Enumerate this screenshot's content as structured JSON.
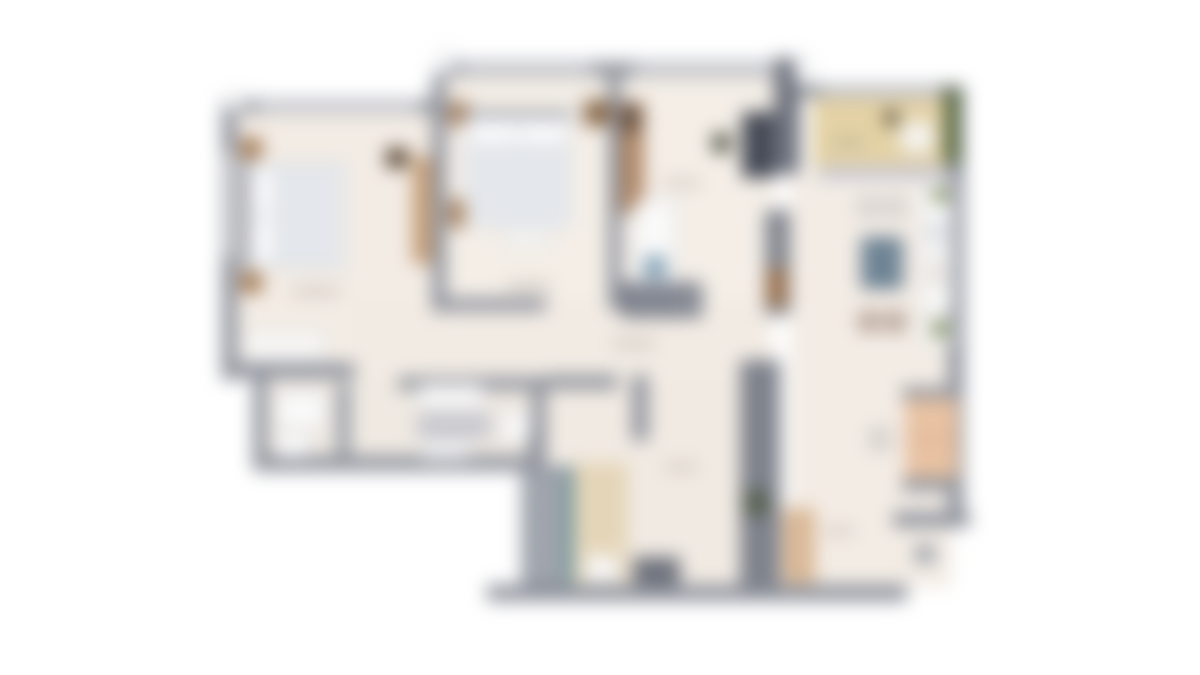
{
  "image": {
    "description": "blurred-apartment-floorplan",
    "width": 1200,
    "height": 675,
    "background": "#ffffff"
  },
  "palette": {
    "wall_gray": "#8d919b",
    "wall_dark": "#6f737e",
    "floor_cream": "#f3ece5",
    "balcony_tan": "#e4d2a6",
    "hedge_green": "#55663e",
    "wood_brown": "#a37a54",
    "mattress_white": "#e9ebee",
    "table_slate": "#6e8495",
    "sofa_peach": "#e8c2a2",
    "stair_teal": "#5f8d96",
    "stair_beige": "#e7d8bc",
    "label_smudge": "#b6afa8"
  },
  "floorplan": {
    "regions": [
      {
        "name": "floor-left-bedroom",
        "x": 228,
        "y": 106,
        "w": 217,
        "h": 268,
        "fill": "#f3ece5"
      },
      {
        "name": "floor-middle-block",
        "x": 446,
        "y": 76,
        "w": 330,
        "h": 236,
        "fill": "#f4eee7"
      },
      {
        "name": "floor-right-block",
        "x": 790,
        "y": 172,
        "w": 162,
        "h": 415,
        "fill": "#f3ece5"
      },
      {
        "name": "floor-hall-mid",
        "x": 352,
        "y": 300,
        "w": 420,
        "h": 82,
        "fill": "#f2ebe4"
      },
      {
        "name": "floor-bottom-block",
        "x": 542,
        "y": 382,
        "w": 200,
        "h": 206,
        "fill": "#f1eae3"
      },
      {
        "name": "floor-bathrooms",
        "x": 255,
        "y": 377,
        "w": 290,
        "h": 86,
        "fill": "#efe9e2"
      },
      {
        "name": "floor-balcony",
        "x": 812,
        "y": 92,
        "w": 136,
        "h": 78,
        "fill": "#e4d2a6"
      },
      {
        "name": "wall-top-left-block",
        "x": 222,
        "y": 100,
        "w": 226,
        "h": 13,
        "fill": "#8d919b"
      },
      {
        "name": "wall-top-middle-block",
        "x": 436,
        "y": 62,
        "w": 360,
        "h": 14,
        "fill": "#8d919b"
      },
      {
        "name": "wall-top-right-block",
        "x": 790,
        "y": 85,
        "w": 172,
        "h": 12,
        "fill": "#8d919b"
      },
      {
        "name": "wall-left-outer",
        "x": 222,
        "y": 100,
        "w": 15,
        "h": 280,
        "fill": "#8d919b"
      },
      {
        "name": "wall-shaft-top-right",
        "x": 774,
        "y": 58,
        "w": 26,
        "h": 116,
        "fill": "#6f737e"
      },
      {
        "name": "wall-right-outer",
        "x": 948,
        "y": 85,
        "w": 16,
        "h": 442,
        "fill": "#8d919b"
      },
      {
        "name": "wall-bottom-right-living",
        "x": 893,
        "y": 512,
        "w": 77,
        "h": 15,
        "fill": "#8d919b"
      },
      {
        "name": "wall-bottom-main",
        "x": 487,
        "y": 585,
        "w": 420,
        "h": 16,
        "fill": "#8d919b"
      },
      {
        "name": "pillar-outside",
        "x": 915,
        "y": 545,
        "w": 20,
        "h": 18,
        "fill": "#9ba0a8"
      },
      {
        "name": "wall-bed1-bed2",
        "x": 432,
        "y": 76,
        "w": 14,
        "h": 236,
        "fill": "#8d919b"
      },
      {
        "name": "wall-bed2-room3",
        "x": 608,
        "y": 76,
        "w": 13,
        "h": 234,
        "fill": "#8d919b"
      },
      {
        "name": "wall-bed1-bottom",
        "x": 222,
        "y": 363,
        "w": 133,
        "h": 15,
        "fill": "#8d919b"
      },
      {
        "name": "wall-bath-left",
        "x": 253,
        "y": 370,
        "w": 14,
        "h": 100,
        "fill": "#8d919b"
      },
      {
        "name": "wall-bath-bottom",
        "x": 253,
        "y": 456,
        "w": 293,
        "h": 15,
        "fill": "#8d919b"
      },
      {
        "name": "wall-bath-divider",
        "x": 337,
        "y": 383,
        "w": 13,
        "h": 78,
        "fill": "#9196a0"
      },
      {
        "name": "wall-bath-right",
        "x": 532,
        "y": 377,
        "w": 14,
        "h": 84,
        "fill": "#8d919b"
      },
      {
        "name": "wall-bath2-top",
        "x": 398,
        "y": 377,
        "w": 148,
        "h": 13,
        "fill": "#8d919b"
      },
      {
        "name": "wall-bed2-bottom",
        "x": 446,
        "y": 298,
        "w": 100,
        "h": 13,
        "fill": "#8d919b"
      },
      {
        "name": "wall-hall-top",
        "x": 545,
        "y": 375,
        "w": 73,
        "h": 14,
        "fill": "#8d919b"
      },
      {
        "name": "wall-hall-stub",
        "x": 632,
        "y": 375,
        "w": 16,
        "h": 66,
        "fill": "#8d919b"
      },
      {
        "name": "wall-shaft-mid",
        "x": 765,
        "y": 210,
        "w": 25,
        "h": 105,
        "fill": "#81858f"
      },
      {
        "name": "wall-shaft-bottom",
        "x": 740,
        "y": 360,
        "w": 40,
        "h": 228,
        "fill": "#7e828c"
      },
      {
        "name": "shaft-door-green",
        "x": 744,
        "y": 490,
        "w": 24,
        "h": 26,
        "fill": "#57604f"
      },
      {
        "name": "wall-stair-left",
        "x": 528,
        "y": 430,
        "w": 14,
        "h": 158,
        "fill": "#8d919b"
      },
      {
        "name": "window-strip",
        "x": 258,
        "y": 103,
        "w": 160,
        "h": 8,
        "fill": "#d9dade"
      },
      {
        "name": "window-strip",
        "x": 462,
        "y": 65,
        "w": 130,
        "h": 8,
        "fill": "#d9dade"
      },
      {
        "name": "window-strip",
        "x": 635,
        "y": 65,
        "w": 140,
        "h": 8,
        "fill": "#d9dade"
      },
      {
        "name": "window-strip",
        "x": 822,
        "y": 88,
        "w": 118,
        "h": 7,
        "fill": "#d9dade"
      },
      {
        "name": "window-strip",
        "x": 225,
        "y": 152,
        "w": 8,
        "h": 105,
        "fill": "#d9dade"
      },
      {
        "name": "window-tab",
        "x": 226,
        "y": 92,
        "w": 17,
        "h": 19,
        "fill": "#fefefe",
        "stroke": "#aeb1b8"
      },
      {
        "name": "window-tab",
        "x": 437,
        "y": 50,
        "w": 16,
        "h": 23,
        "fill": "#fefefe",
        "stroke": "#aeb1b8"
      },
      {
        "name": "window-tab",
        "x": 795,
        "y": 57,
        "w": 17,
        "h": 26,
        "fill": "#fefefe",
        "stroke": "#aeb1b8"
      },
      {
        "name": "balcony-hedge",
        "x": 944,
        "y": 88,
        "w": 16,
        "h": 76,
        "fill": "#55663e"
      },
      {
        "name": "balcony-plant",
        "x": 884,
        "y": 110,
        "w": 15,
        "h": 16,
        "fill": "#57503c",
        "radius": 7
      },
      {
        "name": "balcony-lounge-chair",
        "x": 900,
        "y": 121,
        "w": 34,
        "h": 32,
        "fill": "#f6f4f0",
        "stroke": "#c9c4ba",
        "radius": 6
      },
      {
        "name": "balcony-sliding-door",
        "x": 818,
        "y": 166,
        "w": 130,
        "h": 13,
        "fill": "#c6c6d2"
      },
      {
        "name": "bed1-headboard",
        "x": 241,
        "y": 160,
        "w": 8,
        "h": 110,
        "fill": "#9a9da6"
      },
      {
        "name": "bed1-mattress",
        "x": 249,
        "y": 162,
        "w": 97,
        "h": 107,
        "fill": "#e9ebee",
        "stroke": "#c6c9ce"
      },
      {
        "name": "bed1-pillow",
        "x": 253,
        "y": 170,
        "w": 17,
        "h": 43,
        "fill": "#fbfbfc",
        "radius": 5
      },
      {
        "name": "bed1-pillow",
        "x": 253,
        "y": 219,
        "w": 17,
        "h": 43,
        "fill": "#fbfbfc",
        "radius": 5
      },
      {
        "name": "bed1-blanket",
        "x": 272,
        "y": 164,
        "w": 74,
        "h": 103,
        "fill": "#e4e7eb"
      },
      {
        "name": "bed1-nightstand",
        "x": 240,
        "y": 138,
        "w": 22,
        "h": 21,
        "fill": "#a37a54"
      },
      {
        "name": "bed1-nightstand",
        "x": 240,
        "y": 272,
        "w": 22,
        "h": 21,
        "fill": "#a37a54"
      },
      {
        "name": "bed1-dresser",
        "x": 243,
        "y": 330,
        "w": 83,
        "h": 33,
        "fill": "#f7f6f4",
        "stroke": "#b9bcc1"
      },
      {
        "name": "bed1-dark-item",
        "x": 386,
        "y": 148,
        "w": 22,
        "h": 20,
        "fill": "#5c4a38"
      },
      {
        "name": "bed1-wardrobe",
        "x": 412,
        "y": 156,
        "w": 20,
        "h": 108,
        "fill": "#c7a17b"
      },
      {
        "name": "bed2-nightstand",
        "x": 449,
        "y": 102,
        "w": 20,
        "h": 24,
        "fill": "#a37a54"
      },
      {
        "name": "bed2-side-chest",
        "x": 449,
        "y": 199,
        "w": 19,
        "h": 29,
        "fill": "#a37a54"
      },
      {
        "name": "bed2-headboard",
        "x": 462,
        "y": 110,
        "w": 110,
        "h": 8,
        "fill": "#9a9da6"
      },
      {
        "name": "bed2-mattress",
        "x": 464,
        "y": 117,
        "w": 107,
        "h": 111,
        "fill": "#e9ebee",
        "stroke": "#c6c9ce"
      },
      {
        "name": "bed2-pillow",
        "x": 470,
        "y": 122,
        "w": 46,
        "h": 19,
        "fill": "#fbfbfc",
        "radius": 5
      },
      {
        "name": "bed2-pillow",
        "x": 521,
        "y": 122,
        "w": 45,
        "h": 19,
        "fill": "#fbfbfc",
        "radius": 5
      },
      {
        "name": "bed2-blanket",
        "x": 464,
        "y": 143,
        "w": 107,
        "h": 85,
        "fill": "#e4e7eb"
      },
      {
        "name": "bed2-bench",
        "x": 503,
        "y": 230,
        "w": 48,
        "h": 18,
        "fill": "#f7f6f4",
        "stroke": "#b9bcc1"
      },
      {
        "name": "bed2-nightstand",
        "x": 584,
        "y": 100,
        "w": 26,
        "h": 26,
        "fill": "#8a6a4a"
      },
      {
        "name": "room3-wardrobe",
        "x": 620,
        "y": 102,
        "w": 24,
        "h": 112,
        "fill": "#b08969"
      },
      {
        "name": "room3-wardrobe-dark",
        "x": 621,
        "y": 104,
        "w": 20,
        "h": 28,
        "fill": "#6b5340"
      },
      {
        "name": "room3-desk",
        "x": 742,
        "y": 112,
        "w": 32,
        "h": 66,
        "fill": "#454a56"
      },
      {
        "name": "room3-chair",
        "x": 712,
        "y": 133,
        "w": 19,
        "h": 20,
        "fill": "#5d6052"
      },
      {
        "name": "room3-door-leaf",
        "x": 766,
        "y": 268,
        "w": 21,
        "h": 38,
        "fill": "#9b7350"
      },
      {
        "name": "stair-upper-landing",
        "x": 634,
        "y": 200,
        "w": 42,
        "h": 84,
        "fill": "#fafafa",
        "stroke": "#b5b8bd"
      },
      {
        "name": "stair-upper-blue",
        "x": 644,
        "y": 256,
        "w": 22,
        "h": 22,
        "fill": "#7f9fb3"
      },
      {
        "name": "stair-mid-dark",
        "x": 622,
        "y": 282,
        "w": 80,
        "h": 36,
        "fill": "#6f7480"
      },
      {
        "name": "stair-tread",
        "x": 638,
        "y": 284,
        "w": 3,
        "h": 32,
        "fill": "#e8e8ea"
      },
      {
        "name": "stair-tread",
        "x": 656,
        "y": 284,
        "w": 3,
        "h": 32,
        "fill": "#e8e8ea"
      },
      {
        "name": "stair-tread",
        "x": 674,
        "y": 284,
        "w": 3,
        "h": 32,
        "fill": "#e8e8ea"
      },
      {
        "name": "stair-tread",
        "x": 690,
        "y": 284,
        "w": 3,
        "h": 32,
        "fill": "#e8e8ea"
      },
      {
        "name": "stair-flight-gray",
        "x": 521,
        "y": 466,
        "w": 44,
        "h": 120,
        "fill": "#999ea7"
      },
      {
        "name": "stair-tread",
        "x": 523,
        "y": 486,
        "w": 40,
        "h": 3,
        "fill": "#c6c9ce"
      },
      {
        "name": "stair-tread",
        "x": 523,
        "y": 506,
        "w": 40,
        "h": 3,
        "fill": "#c6c9ce"
      },
      {
        "name": "stair-tread",
        "x": 523,
        "y": 526,
        "w": 40,
        "h": 3,
        "fill": "#c6c9ce"
      },
      {
        "name": "stair-tread",
        "x": 523,
        "y": 546,
        "w": 40,
        "h": 3,
        "fill": "#c6c9ce"
      },
      {
        "name": "stair-tread",
        "x": 523,
        "y": 566,
        "w": 40,
        "h": 3,
        "fill": "#c6c9ce"
      },
      {
        "name": "stair-divider-teal",
        "x": 565,
        "y": 466,
        "w": 8,
        "h": 118,
        "fill": "#5f8d96"
      },
      {
        "name": "stair-flight-beige",
        "x": 573,
        "y": 462,
        "w": 55,
        "h": 122,
        "fill": "#e7d8bc"
      },
      {
        "name": "stair-tread",
        "x": 575,
        "y": 478,
        "w": 51,
        "h": 2,
        "fill": "#cdbd9e"
      },
      {
        "name": "stair-tread",
        "x": 575,
        "y": 496,
        "w": 51,
        "h": 2,
        "fill": "#cdbd9e"
      },
      {
        "name": "stair-tread",
        "x": 575,
        "y": 514,
        "w": 51,
        "h": 2,
        "fill": "#cdbd9e"
      },
      {
        "name": "stair-tread",
        "x": 575,
        "y": 532,
        "w": 51,
        "h": 2,
        "fill": "#cdbd9e"
      },
      {
        "name": "stair-landing",
        "x": 586,
        "y": 556,
        "w": 32,
        "h": 26,
        "fill": "#fafafa",
        "stroke": "#c0c3c8"
      },
      {
        "name": "entry-mat",
        "x": 633,
        "y": 557,
        "w": 47,
        "h": 28,
        "fill": "#6e727c"
      },
      {
        "name": "bath1-shower",
        "x": 276,
        "y": 391,
        "w": 50,
        "h": 38,
        "fill": "#fafafa",
        "stroke": "#b5b8bd"
      },
      {
        "name": "bath1-toilet",
        "x": 278,
        "y": 433,
        "w": 31,
        "h": 25,
        "fill": "#fbfbfc",
        "stroke": "#c0c3c8",
        "radius": 6
      },
      {
        "name": "bath2-tub",
        "x": 417,
        "y": 384,
        "w": 68,
        "h": 24,
        "fill": "#fafafa",
        "stroke": "#b5b8bd",
        "radius": 8
      },
      {
        "name": "bath2-counter",
        "x": 417,
        "y": 412,
        "w": 74,
        "h": 27,
        "fill": "#c9c9cf"
      },
      {
        "name": "bath2-toilet",
        "x": 501,
        "y": 414,
        "w": 30,
        "h": 27,
        "fill": "#fbfbfc",
        "stroke": "#c0c3c8",
        "radius": 9
      },
      {
        "name": "bath2-sink",
        "x": 421,
        "y": 442,
        "w": 48,
        "h": 18,
        "fill": "#f2f2f4",
        "stroke": "#c0c3c8"
      },
      {
        "name": "dining-chair",
        "x": 858,
        "y": 197,
        "w": 22,
        "h": 20,
        "fill": "#d9d5d1",
        "stroke": "#adb0b5",
        "radius": 5
      },
      {
        "name": "dining-chair",
        "x": 884,
        "y": 197,
        "w": 22,
        "h": 20,
        "fill": "#d9d5d1",
        "stroke": "#adb0b5",
        "radius": 5
      },
      {
        "name": "dining-table",
        "x": 861,
        "y": 237,
        "w": 42,
        "h": 52,
        "fill": "#6e8495",
        "stroke": "#5a6e7e"
      },
      {
        "name": "dining-chair",
        "x": 858,
        "y": 311,
        "w": 22,
        "h": 21,
        "fill": "#b9a79b",
        "stroke": "#a3968c",
        "radius": 5
      },
      {
        "name": "dining-chair",
        "x": 884,
        "y": 311,
        "w": 22,
        "h": 21,
        "fill": "#b9a79b",
        "stroke": "#a3968c",
        "radius": 5
      },
      {
        "name": "kitchen-counter",
        "x": 921,
        "y": 182,
        "w": 32,
        "h": 130,
        "fill": "#fafafa",
        "stroke": "#bfc2c7"
      },
      {
        "name": "kitchen-sink",
        "x": 927,
        "y": 220,
        "w": 20,
        "h": 26,
        "fill": "#dfe2e6"
      },
      {
        "name": "kitchen-stove",
        "x": 927,
        "y": 258,
        "w": 20,
        "h": 30,
        "fill": "#e8e5e1"
      },
      {
        "name": "kitchen-plant",
        "x": 932,
        "y": 187,
        "w": 17,
        "h": 16,
        "fill": "#7a8b5a",
        "radius": 8
      },
      {
        "name": "kitchen-cabinet",
        "x": 921,
        "y": 316,
        "w": 32,
        "h": 30,
        "fill": "#fafafa",
        "stroke": "#bfc2c7"
      },
      {
        "name": "kitchen-plant",
        "x": 931,
        "y": 320,
        "w": 18,
        "h": 18,
        "fill": "#7a8b5a",
        "radius": 9
      },
      {
        "name": "sofa-armrest",
        "x": 902,
        "y": 387,
        "w": 57,
        "h": 13,
        "fill": "#8f939d"
      },
      {
        "name": "sofa-body",
        "x": 905,
        "y": 398,
        "w": 53,
        "h": 84,
        "fill": "#e8c2a2"
      },
      {
        "name": "sofa-cushion-line",
        "x": 905,
        "y": 438,
        "w": 53,
        "h": 3,
        "fill": "#d9ad8d"
      },
      {
        "name": "sofa-armrest",
        "x": 902,
        "y": 478,
        "w": 57,
        "h": 13,
        "fill": "#8f939d"
      },
      {
        "name": "side-table",
        "x": 869,
        "y": 427,
        "w": 22,
        "h": 24,
        "fill": "#d8d3cd",
        "stroke": "#b9bcc1"
      },
      {
        "name": "tv-cabinet",
        "x": 782,
        "y": 508,
        "w": 33,
        "h": 76,
        "fill": "#d9b896"
      },
      {
        "name": "room-label-smudge",
        "x": 292,
        "y": 287,
        "w": 48,
        "h": 9,
        "fill": "#b6afa8",
        "radius": 4,
        "opacity": 0.55
      },
      {
        "name": "room-label-smudge",
        "x": 506,
        "y": 282,
        "w": 45,
        "h": 9,
        "fill": "#b6afa8",
        "radius": 4,
        "opacity": 0.55
      },
      {
        "name": "room-label-smudge",
        "x": 663,
        "y": 179,
        "w": 38,
        "h": 8,
        "fill": "#b6afa8",
        "radius": 4,
        "opacity": 0.55
      },
      {
        "name": "room-label-smudge",
        "x": 833,
        "y": 138,
        "w": 31,
        "h": 8,
        "fill": "#a9a391",
        "radius": 4,
        "opacity": 0.6
      },
      {
        "name": "room-label-smudge",
        "x": 612,
        "y": 339,
        "w": 43,
        "h": 9,
        "fill": "#b6afa8",
        "radius": 4,
        "opacity": 0.55
      },
      {
        "name": "room-label-smudge",
        "x": 824,
        "y": 527,
        "w": 31,
        "h": 8,
        "fill": "#b6afa8",
        "radius": 4,
        "opacity": 0.55
      },
      {
        "name": "room-label-smudge",
        "x": 664,
        "y": 463,
        "w": 34,
        "h": 8,
        "fill": "#b6afa8",
        "radius": 4,
        "opacity": 0.55
      }
    ]
  }
}
